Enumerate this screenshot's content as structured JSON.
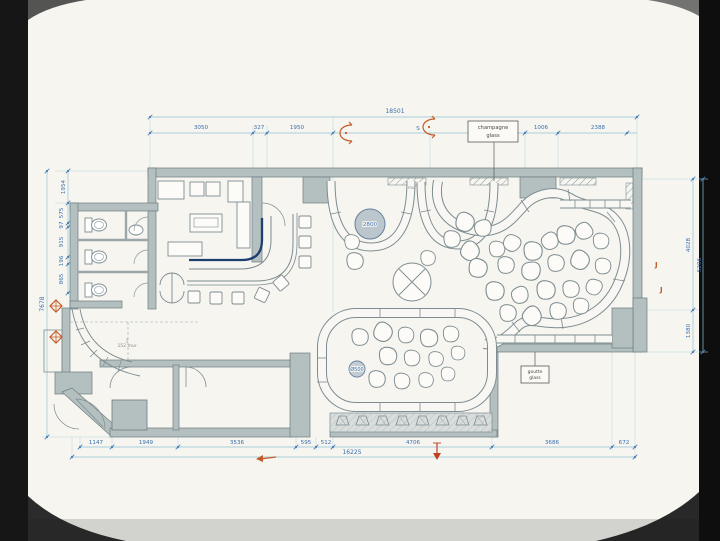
{
  "plan": {
    "annotations": {
      "champagne_line1": "champagne",
      "champagne_line2": "glass",
      "goutte_line1": "goutte",
      "goutte_line2": "glass",
      "big_circle_diameter": "2800",
      "small_circle_diameter": "Ø500",
      "wall_note": "152 mur",
      "top_wall_note": "mur",
      "marker_s_label": "S",
      "marker_j1_label": "J",
      "marker_j2_label": "J"
    },
    "dimensions": {
      "top_total": "18501",
      "top_chain": [
        "3050",
        "327",
        "1950",
        "1006",
        "2388"
      ],
      "bottom_chain": [
        "1147",
        "1949",
        "3536",
        "595",
        "512",
        "4706",
        "3686",
        "672"
      ],
      "bottom_total": "16225",
      "left_chain": [
        "1954",
        "575",
        "97",
        "915",
        "196",
        "865"
      ],
      "left_total": "7678",
      "right_chain": [
        "4028",
        "5206",
        "1380"
      ]
    },
    "colors": {
      "paper": "#f6f5f0",
      "dimension_line": "#8fc3d4",
      "dimension_text": "#3a6fae",
      "wall_fill": "#b4bfbf",
      "line_work": "#7e8c91",
      "bar_counter_edge": "#1c3f6e",
      "section_marker": "#c35a26"
    }
  }
}
